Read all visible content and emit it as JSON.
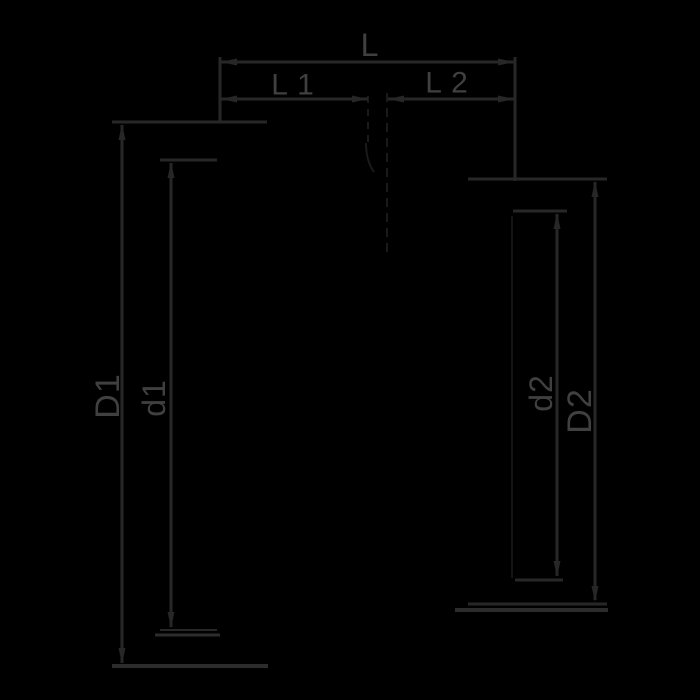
{
  "title": "reducer-fitting-dimension-drawing",
  "diagram": {
    "canvas": {
      "width": 700,
      "height": 700,
      "background": "#000000"
    },
    "colors": {
      "line": "#272727",
      "thick_line": "#2c2c2c",
      "text": "#404040",
      "faint": "#1a1a1a",
      "very_faint": "#141414"
    },
    "labels": [
      {
        "name": "label-L",
        "text": "L",
        "x": 370,
        "y": 45,
        "rotate": 0,
        "size": 32
      },
      {
        "name": "label-L1",
        "text": "L 1",
        "x": 293,
        "y": 85,
        "rotate": 0,
        "size": 30
      },
      {
        "name": "label-L2",
        "text": "L 2",
        "x": 447,
        "y": 83,
        "rotate": 0,
        "size": 30
      },
      {
        "name": "label-D1",
        "text": "D1",
        "x": 108,
        "y": 396,
        "rotate": -90,
        "size": 34
      },
      {
        "name": "label-d1",
        "text": "d1",
        "x": 154,
        "y": 398,
        "rotate": -90,
        "size": 32
      },
      {
        "name": "label-d2",
        "text": "d2",
        "x": 541,
        "y": 393,
        "rotate": -90,
        "size": 32
      },
      {
        "name": "label-D2",
        "text": "D2",
        "x": 580,
        "y": 411,
        "rotate": -90,
        "size": 34
      }
    ],
    "lines": [
      {
        "name": "dim-line-L",
        "x1": 221,
        "y1": 62,
        "x2": 515,
        "y2": 62,
        "w": 3,
        "kind": "line"
      },
      {
        "name": "ext-line-left-top",
        "x1": 220,
        "y1": 57,
        "x2": 220,
        "y2": 123,
        "w": 3,
        "kind": "line"
      },
      {
        "name": "ext-line-right-top",
        "x1": 515,
        "y1": 57,
        "x2": 515,
        "y2": 181,
        "w": 3,
        "kind": "line"
      },
      {
        "name": "dim-line-L1",
        "x1": 221,
        "y1": 99,
        "x2": 368,
        "y2": 99,
        "w": 3,
        "kind": "line"
      },
      {
        "name": "dim-line-L2",
        "x1": 388,
        "y1": 99,
        "x2": 514,
        "y2": 99,
        "w": 3,
        "kind": "line"
      },
      {
        "name": "ext-D1-top",
        "x1": 112,
        "y1": 122,
        "x2": 267,
        "y2": 122,
        "w": 3,
        "kind": "line"
      },
      {
        "name": "dim-line-D1",
        "x1": 122,
        "y1": 125,
        "x2": 122,
        "y2": 663,
        "w": 3,
        "kind": "line"
      },
      {
        "name": "ext-D1-bottom",
        "x1": 112,
        "y1": 666,
        "x2": 268,
        "y2": 666,
        "w": 4,
        "kind": "thick"
      },
      {
        "name": "ext-d1-top",
        "x1": 160,
        "y1": 160,
        "x2": 217,
        "y2": 160,
        "w": 3,
        "kind": "line"
      },
      {
        "name": "dim-line-d1",
        "x1": 171,
        "y1": 163,
        "x2": 171,
        "y2": 627,
        "w": 3,
        "kind": "line"
      },
      {
        "name": "ext-d1-bottom-a",
        "x1": 160,
        "y1": 630,
        "x2": 217,
        "y2": 630,
        "w": 2,
        "kind": "line"
      },
      {
        "name": "ext-d1-bottom-b",
        "x1": 155,
        "y1": 635,
        "x2": 220,
        "y2": 635,
        "w": 3,
        "kind": "thick"
      },
      {
        "name": "ext-D2-top",
        "x1": 468,
        "y1": 179,
        "x2": 607,
        "y2": 179,
        "w": 3,
        "kind": "line"
      },
      {
        "name": "dim-line-D2",
        "x1": 595,
        "y1": 182,
        "x2": 595,
        "y2": 600,
        "w": 3,
        "kind": "line"
      },
      {
        "name": "ext-D2-bottom-a",
        "x1": 468,
        "y1": 604,
        "x2": 607,
        "y2": 604,
        "w": 3,
        "kind": "line"
      },
      {
        "name": "ext-D2-bottom-b",
        "x1": 455,
        "y1": 610,
        "x2": 608,
        "y2": 610,
        "w": 4,
        "kind": "thick"
      },
      {
        "name": "ext-d2-top",
        "x1": 513,
        "y1": 211,
        "x2": 567,
        "y2": 211,
        "w": 3,
        "kind": "line"
      },
      {
        "name": "dim-line-d2",
        "x1": 557,
        "y1": 214,
        "x2": 557,
        "y2": 576,
        "w": 3,
        "kind": "line"
      },
      {
        "name": "ext-d2-bottom",
        "x1": 515,
        "y1": 580,
        "x2": 563,
        "y2": 580,
        "w": 3,
        "kind": "line"
      }
    ],
    "faint_lines": [
      {
        "name": "centerline-dashed",
        "x1": 387,
        "y1": 93,
        "x2": 387,
        "y2": 253,
        "w": 2,
        "dash": "9 6",
        "tone": "faint"
      },
      {
        "name": "edge-dashed-left",
        "x1": 368,
        "y1": 96,
        "x2": 368,
        "y2": 143,
        "w": 2,
        "dash": "7 6",
        "tone": "faint"
      },
      {
        "name": "part-edge-right",
        "x1": 512,
        "y1": 216,
        "x2": 512,
        "y2": 578,
        "w": 2,
        "dash": "",
        "tone": "very_faint"
      }
    ],
    "arcs": [
      {
        "name": "taper-arc",
        "d": "M 366 143 Q 366 161 374 172",
        "w": 2,
        "tone": "faint"
      }
    ],
    "arrows": [
      {
        "name": "arrow-L-left",
        "x": 221,
        "y": 62,
        "dir": "left"
      },
      {
        "name": "arrow-L-right",
        "x": 514,
        "y": 62,
        "dir": "right"
      },
      {
        "name": "arrow-L1-left",
        "x": 221,
        "y": 99,
        "dir": "left"
      },
      {
        "name": "arrow-L1-right",
        "x": 368,
        "y": 99,
        "dir": "right"
      },
      {
        "name": "arrow-L2-left",
        "x": 388,
        "y": 99,
        "dir": "left"
      },
      {
        "name": "arrow-L2-right",
        "x": 514,
        "y": 99,
        "dir": "right"
      },
      {
        "name": "arrow-D1-top",
        "x": 122,
        "y": 124,
        "dir": "up"
      },
      {
        "name": "arrow-D1-bottom",
        "x": 122,
        "y": 664,
        "dir": "down"
      },
      {
        "name": "arrow-d1-top",
        "x": 171,
        "y": 162,
        "dir": "up"
      },
      {
        "name": "arrow-d1-bottom",
        "x": 171,
        "y": 628,
        "dir": "down"
      },
      {
        "name": "arrow-D2-top",
        "x": 595,
        "y": 181,
        "dir": "up"
      },
      {
        "name": "arrow-D2-bottom",
        "x": 595,
        "y": 602,
        "dir": "down"
      },
      {
        "name": "arrow-d2-top",
        "x": 557,
        "y": 213,
        "dir": "up"
      },
      {
        "name": "arrow-d2-bottom",
        "x": 557,
        "y": 577,
        "dir": "down"
      }
    ],
    "arrow_geometry": {
      "length": 16,
      "half_width": 3.5
    }
  }
}
